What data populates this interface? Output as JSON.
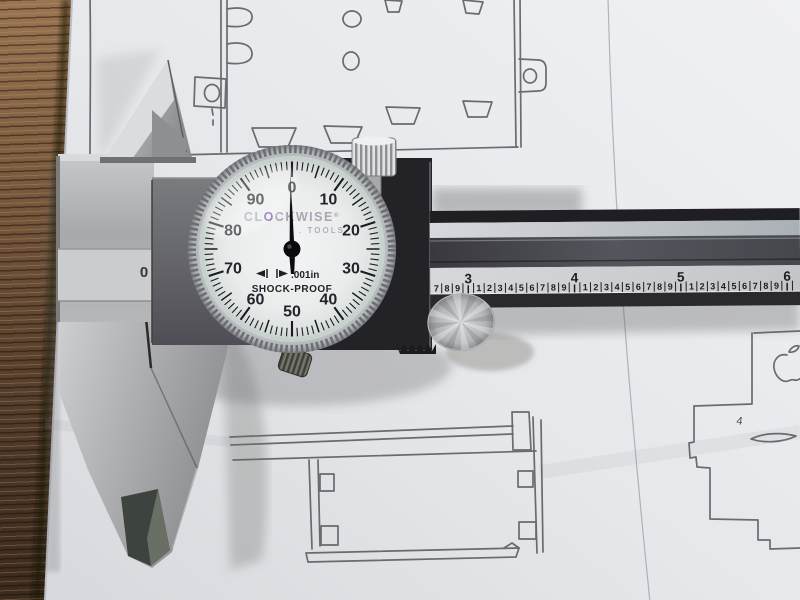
{
  "dial_indicator": {
    "brand_prefix": "CL",
    "brand_logo_letter": "O",
    "brand_suffix": "CKWISE",
    "registered_mark": "®",
    "brand_line2": ". TOOLS",
    "precision_label": ".001in",
    "durability_label": "SHOCK-PROOF",
    "numerals": [
      "0",
      "10",
      "20",
      "30",
      "40",
      "50",
      "60",
      "70",
      "80",
      "90"
    ],
    "needle_value": 0,
    "face_color": "#edeff0",
    "numeral_color": "#23232c",
    "logo_color": "#7a5ca6",
    "brand_text_color": "#a9a5b4",
    "tick_color": "#1a1a20"
  },
  "beam_ruler": {
    "inch_numerals": [
      "3",
      "4",
      "5",
      "6"
    ],
    "tenth_numerals": [
      "1",
      "2",
      "3",
      "4",
      "5",
      "6",
      "7",
      "8",
      "9"
    ],
    "origin_mark": "0",
    "tick_color": "#1d1d22"
  },
  "sketch": {
    "pencil_mark": "4"
  }
}
